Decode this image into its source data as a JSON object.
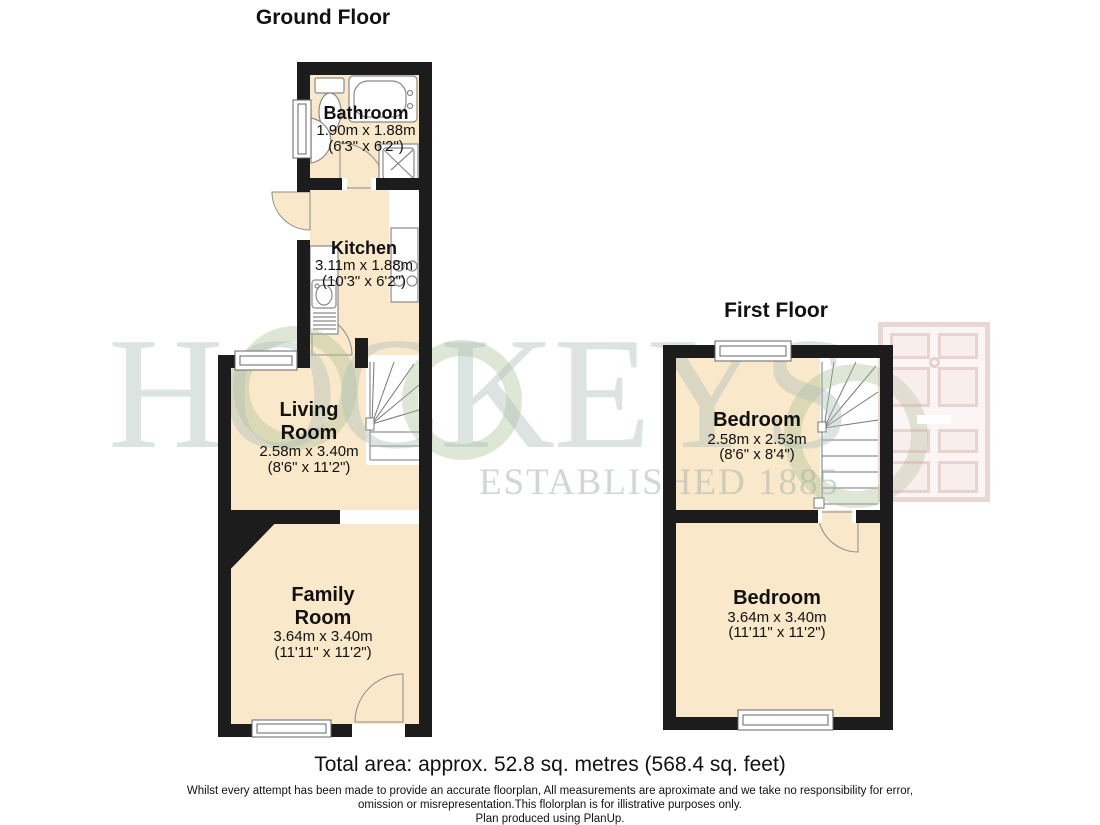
{
  "ground_floor": {
    "title": "Ground Floor",
    "bathroom": {
      "name": "Bathroom",
      "metric": "1.90m x 1.88m",
      "imperial": "(6'3\" x 6'2\")"
    },
    "kitchen": {
      "name": "Kitchen",
      "metric": "3.11m x 1.88m",
      "imperial": "(10'3\" x 6'2\")"
    },
    "living_room": {
      "name": "Living\nRoom",
      "metric": "2.58m x 3.40m",
      "imperial": "(8'6\" x 11'2\")"
    },
    "family_room": {
      "name": "Family\nRoom",
      "metric": "3.64m x 3.40m",
      "imperial": "(11'11\" x 11'2\")"
    }
  },
  "first_floor": {
    "title": "First Floor",
    "bedroom_front": {
      "name": "Bedroom",
      "metric": "2.58m x 2.53m",
      "imperial": "(8'6\" x 8'4\")"
    },
    "bedroom_back": {
      "name": "Bedroom",
      "metric": "3.64m x 3.40m",
      "imperial": "(11'11\" x 11'2\")"
    }
  },
  "watermark": {
    "brand": "HOCKEYS",
    "tagline": "ESTABLISHED 1885"
  },
  "footer": {
    "total_area": "Total area: approx. 52.8 sq. metres (568.4 sq. feet)",
    "disclaimer_1": "Whilst every attempt has been made to provide an accurate floorplan, All measurements are aproximate and we take no responsibility for error,",
    "disclaimer_2": "omission or misrepresentation.This flolorplan is for illistrative purposes only.",
    "produced_by": "Plan produced using PlanUp."
  },
  "colors": {
    "floor_fill": "#FAE8CA",
    "wall": "#1C1C1C",
    "fixture_line": "#8A8A8A",
    "watermark_green": "#A8BE94",
    "watermark_grey": "#ACBEBA",
    "watermark_pink": "#CDA59B"
  }
}
